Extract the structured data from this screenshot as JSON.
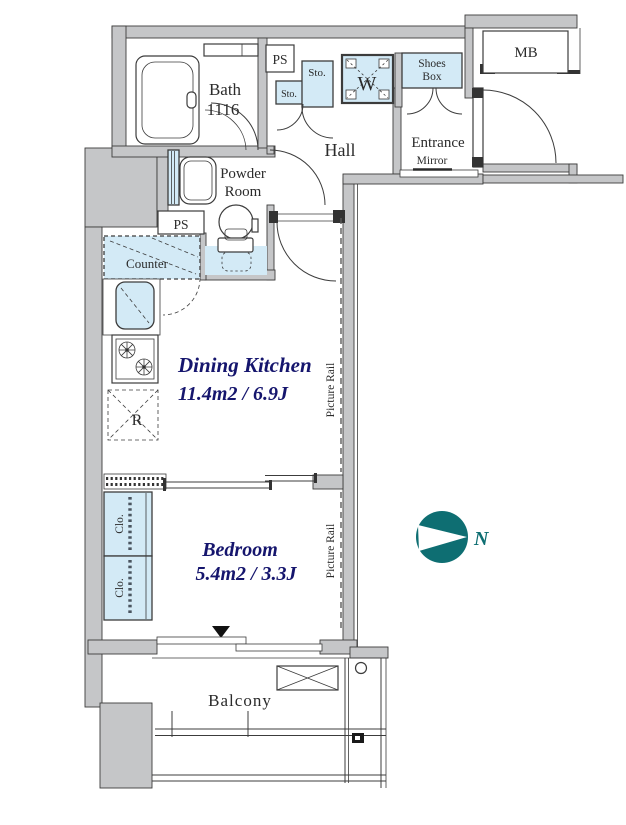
{
  "title": "Apartment floor plan",
  "rooms": {
    "bath": {
      "name": "Bath",
      "size": "1116"
    },
    "powder_room": {
      "line1": "Powder",
      "line2": "Room"
    },
    "hall": {
      "name": "Hall"
    },
    "entrance": {
      "name": "Entrance",
      "mirror": "Mirror"
    },
    "dining_kitchen": {
      "name": "Dining Kitchen",
      "size": "11.4m2 / 6.9J"
    },
    "bedroom": {
      "name": "Bedroom",
      "size": "5.4m2 / 3.3J"
    },
    "balcony": {
      "name": "Balcony"
    }
  },
  "fixtures": {
    "ps_top": "PS",
    "ps_mid": "PS",
    "sto_small": "Sto.",
    "sto_large": "Sto.",
    "washer": "W",
    "shoes_box": {
      "line1": "Shoes",
      "line2": "Box"
    },
    "meter_box": "MB",
    "counter": "Counter",
    "refrigerator": "R",
    "closet_upper": "Clo.",
    "closet_lower": "Clo.",
    "picture_rail_dk": "Picture Rail",
    "picture_rail_bedroom": "Picture Rail"
  },
  "compass": {
    "north": "N"
  },
  "colors": {
    "wall_fill": "#c5c6c8",
    "fixture_fill": "#d3eaf6",
    "line": "#3c3c3c",
    "size_text": "#15156d",
    "compass": "#0e6e72"
  }
}
